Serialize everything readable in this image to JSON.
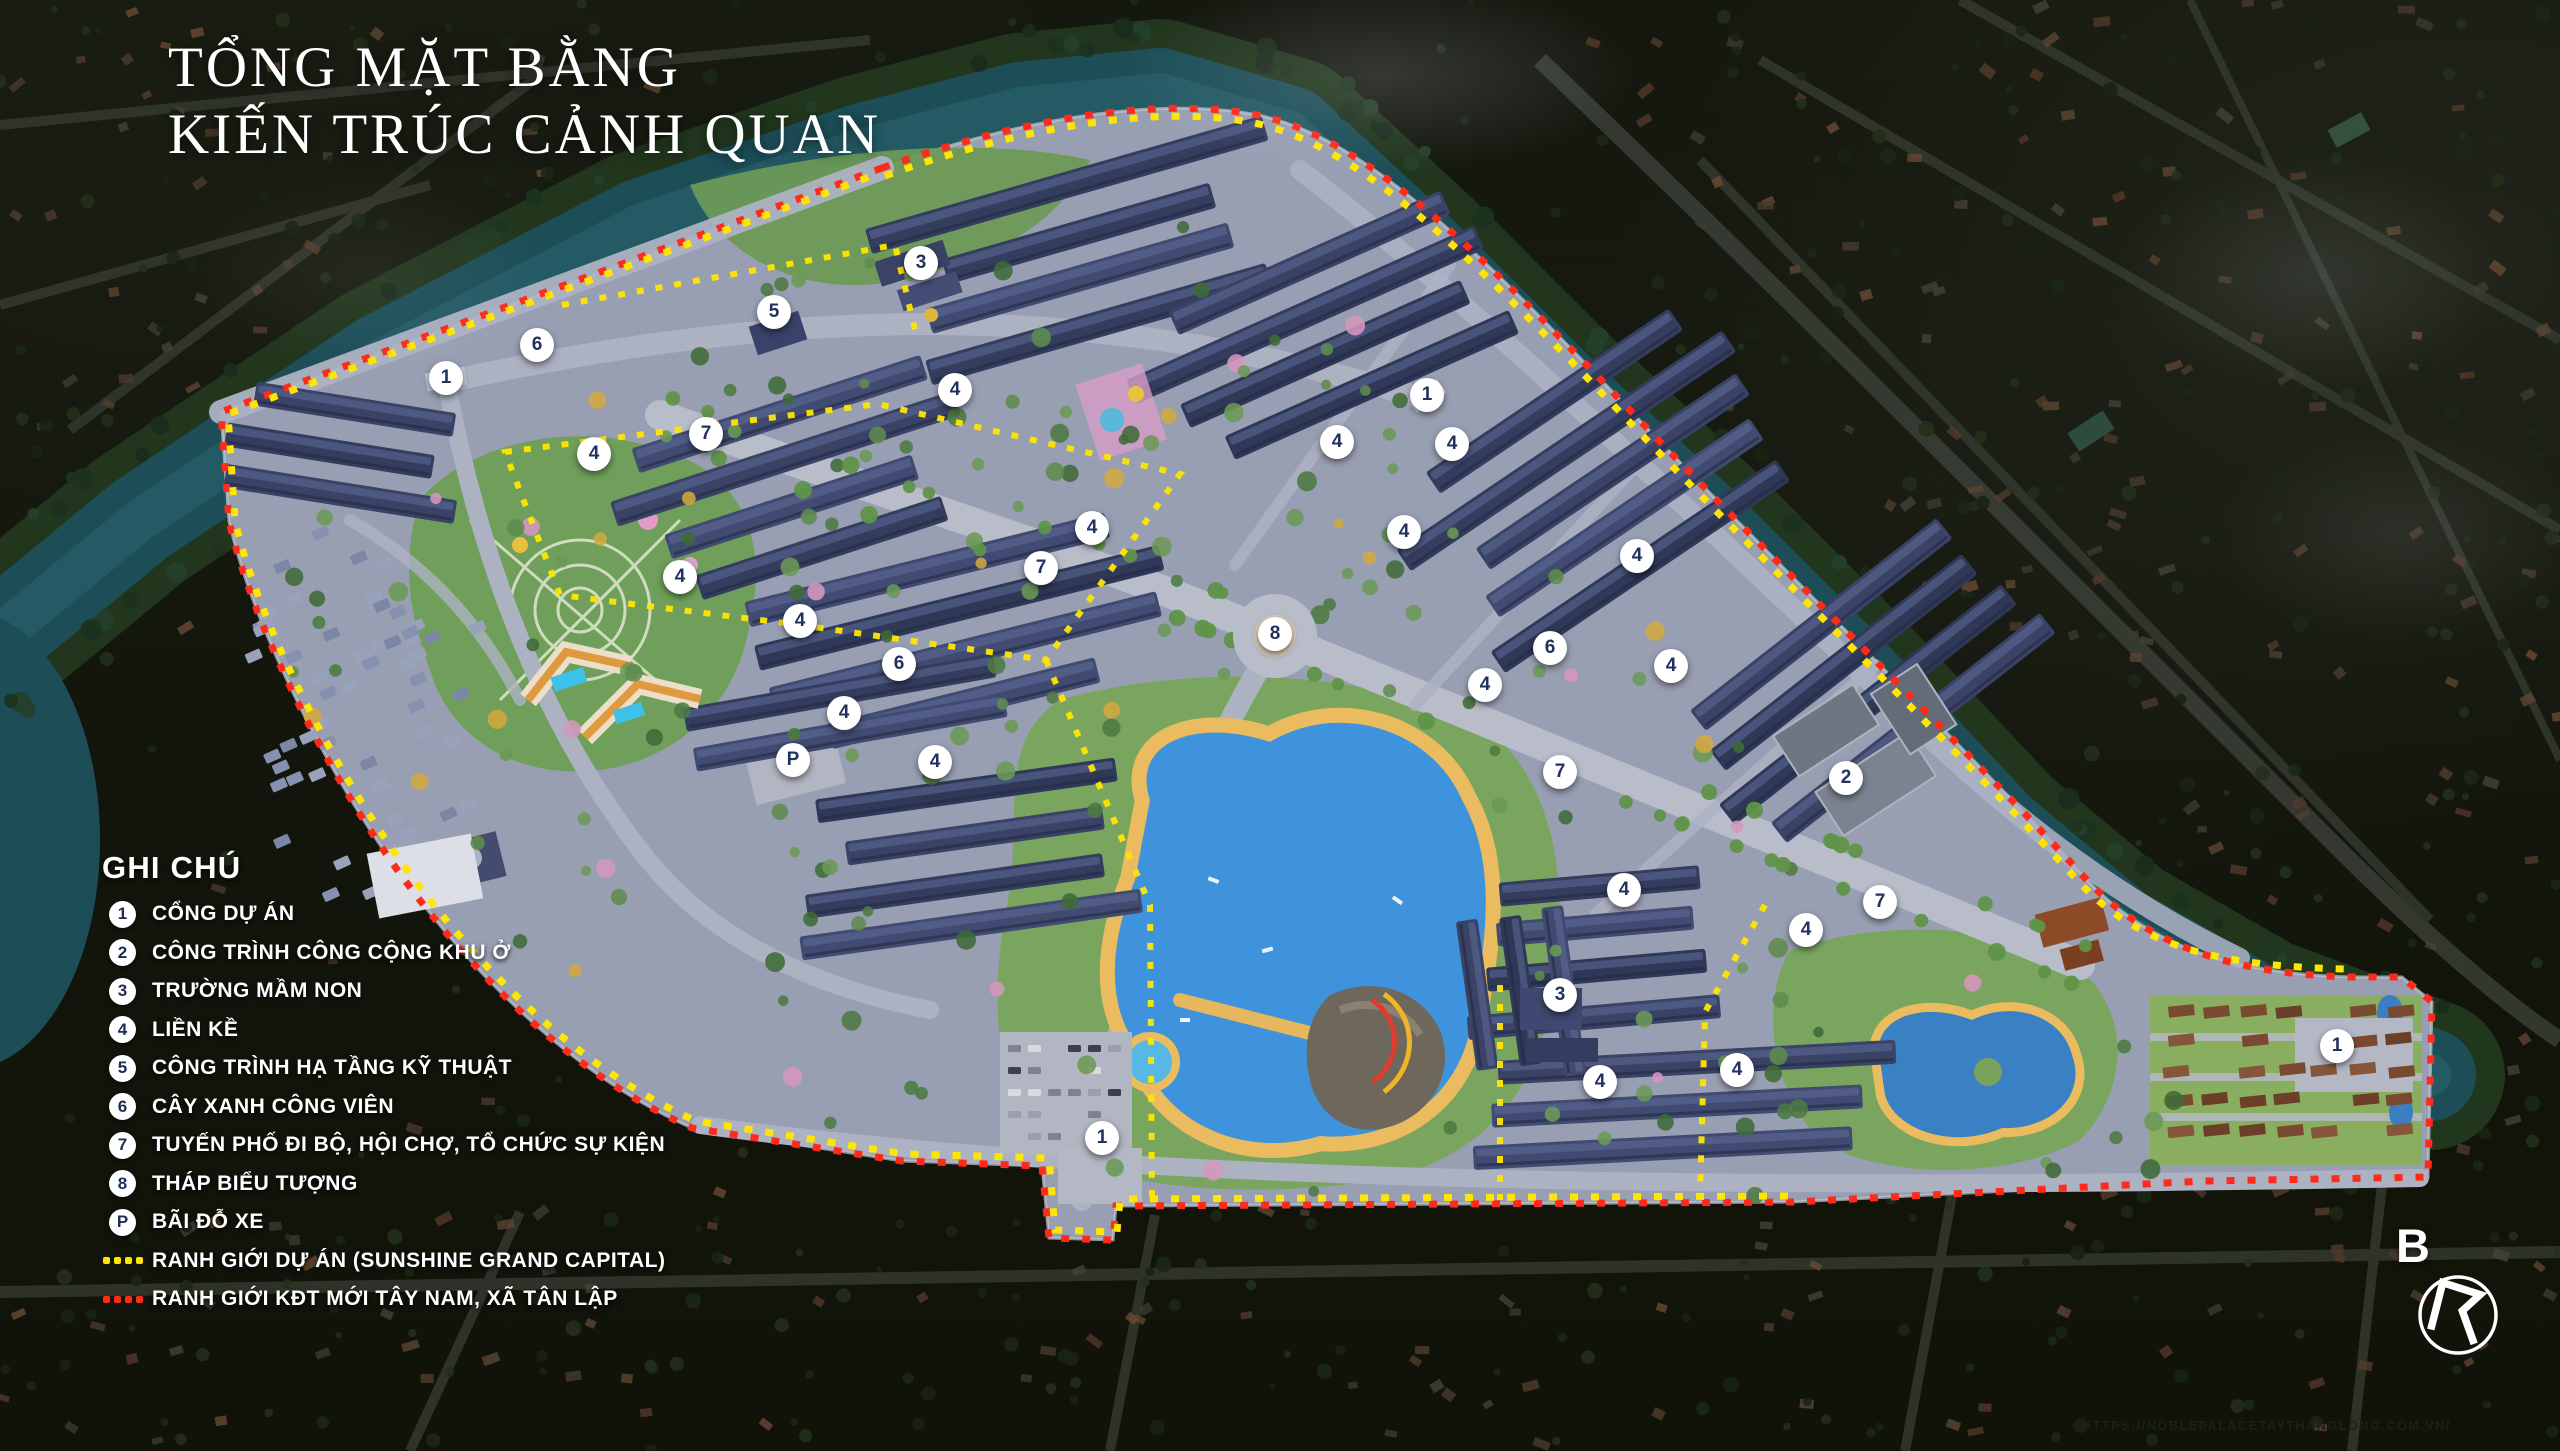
{
  "title": {
    "line1": "TỔNG MẶT BẰNG",
    "line2": "KIẾN TRÚC CẢNH QUAN"
  },
  "legend": {
    "heading": "GHI CHÚ",
    "items": [
      {
        "symbol": "1",
        "type": "circle",
        "label": "CỔNG DỰ ÁN"
      },
      {
        "symbol": "2",
        "type": "circle",
        "label": "CÔNG TRÌNH CÔNG CỘNG KHU Ở"
      },
      {
        "symbol": "3",
        "type": "circle",
        "label": "TRƯỜNG MẦM NON"
      },
      {
        "symbol": "4",
        "type": "circle",
        "label": "LIỀN KỀ"
      },
      {
        "symbol": "5",
        "type": "circle",
        "label": "CÔNG TRÌNH HẠ TẦNG KỸ THUẬT"
      },
      {
        "symbol": "6",
        "type": "circle",
        "label": "CÂY XANH CÔNG VIÊN"
      },
      {
        "symbol": "7",
        "type": "circle",
        "label": "TUYẾN PHỐ ĐI BỘ, HỘI CHỢ, TỔ CHỨC SỰ KIỆN"
      },
      {
        "symbol": "8",
        "type": "circle",
        "label": "THÁP BIỂU TƯỢNG"
      },
      {
        "symbol": "P",
        "type": "circle",
        "label": "BÃI ĐỖ XE"
      },
      {
        "symbol": "dots",
        "type": "dots",
        "color": "#ffe600",
        "label": "RANH GIỚI DỰ ÁN (SUNSHINE GRAND CAPITAL)"
      },
      {
        "symbol": "dots",
        "type": "dots",
        "color": "#ff2a1a",
        "label": "RANH GIỚI KĐT MỚI TÂY NAM, XÃ TÂN LẬP"
      }
    ]
  },
  "compass": {
    "label": "B"
  },
  "watermark": {
    "url_text": "HTTPS://NOBLEPALACETAYTHANGLONG.COM.VN/"
  },
  "colors": {
    "boundary_project_yellow": "#ffe600",
    "boundary_kdt_red": "#ff2a1a",
    "marker_bg": "#ffffff",
    "marker_text": "#22325e",
    "canal_water": "#1d4e58",
    "lake_water": "#3f93dc",
    "title_text": "#ffffff"
  },
  "map_markers": [
    {
      "label": "3",
      "x": 921,
      "y": 263
    },
    {
      "label": "5",
      "x": 774,
      "y": 312
    },
    {
      "label": "6",
      "x": 537,
      "y": 345
    },
    {
      "label": "1",
      "x": 446,
      "y": 378
    },
    {
      "label": "4",
      "x": 955,
      "y": 390
    },
    {
      "label": "1",
      "x": 1427,
      "y": 395
    },
    {
      "label": "7",
      "x": 706,
      "y": 434
    },
    {
      "label": "4",
      "x": 594,
      "y": 454
    },
    {
      "label": "4",
      "x": 1337,
      "y": 442
    },
    {
      "label": "4",
      "x": 1452,
      "y": 444
    },
    {
      "label": "4",
      "x": 1092,
      "y": 528
    },
    {
      "label": "4",
      "x": 1404,
      "y": 532
    },
    {
      "label": "7",
      "x": 1041,
      "y": 568
    },
    {
      "label": "4",
      "x": 1637,
      "y": 556
    },
    {
      "label": "4",
      "x": 680,
      "y": 577
    },
    {
      "label": "8",
      "x": 1275,
      "y": 634
    },
    {
      "label": "6",
      "x": 1550,
      "y": 648
    },
    {
      "label": "4",
      "x": 1671,
      "y": 666
    },
    {
      "label": "4",
      "x": 800,
      "y": 621
    },
    {
      "label": "6",
      "x": 899,
      "y": 664
    },
    {
      "label": "4",
      "x": 844,
      "y": 713
    },
    {
      "label": "4",
      "x": 1485,
      "y": 685
    },
    {
      "label": "P",
      "x": 793,
      "y": 760
    },
    {
      "label": "4",
      "x": 935,
      "y": 762
    },
    {
      "label": "7",
      "x": 1560,
      "y": 772
    },
    {
      "label": "2",
      "x": 1846,
      "y": 778
    },
    {
      "label": "7",
      "x": 1880,
      "y": 902
    },
    {
      "label": "4",
      "x": 1624,
      "y": 890
    },
    {
      "label": "4",
      "x": 1806,
      "y": 930
    },
    {
      "label": "3",
      "x": 1560,
      "y": 995
    },
    {
      "label": "4",
      "x": 1600,
      "y": 1082
    },
    {
      "label": "4",
      "x": 1737,
      "y": 1070
    },
    {
      "label": "1",
      "x": 2337,
      "y": 1046
    },
    {
      "label": "1",
      "x": 1102,
      "y": 1138
    }
  ]
}
